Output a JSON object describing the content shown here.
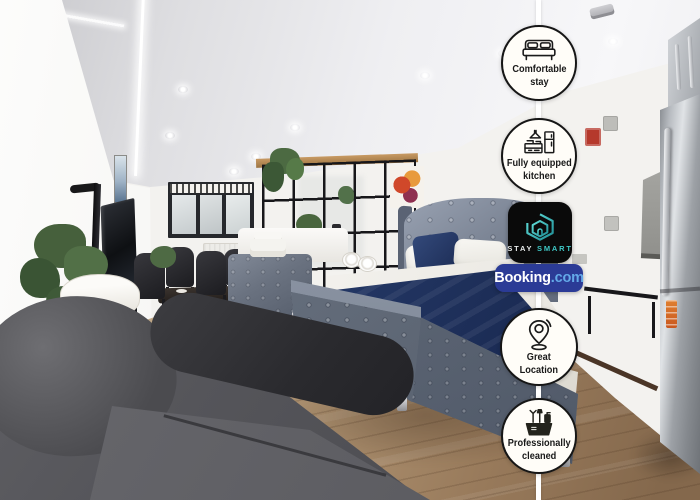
{
  "photo": {
    "alt": "Bright studio apartment: grey velvet beds with navy bedding, grey sofa, dining table with black chairs, black shelving room divider with plants, lamp, TV and stainless steel kitchen"
  },
  "overlay": {
    "connector_color": "#ffffff",
    "badges": [
      {
        "id": "comfortable-stay",
        "icon": "bed-icon",
        "lines": [
          "Comfortable",
          "stay"
        ]
      },
      {
        "id": "fully-equipped-kitchen",
        "icon": "kitchen-icon",
        "lines": [
          "Fully equipped",
          "kitchen"
        ]
      },
      {
        "id": "great-location",
        "icon": "location-pin-icon",
        "lines": [
          "Great",
          "Location"
        ]
      },
      {
        "id": "professionally-cleaned",
        "icon": "cleaning-basket-icon",
        "lines": [
          "Professionally",
          "cleaned"
        ]
      }
    ],
    "staysmart": {
      "line1": "STAY",
      "line2": "SMART",
      "bg": "#0a0a0a",
      "accent": "#3fc8c6",
      "text_color": "#e9ecec"
    },
    "booking": {
      "brand": "Booking",
      "suffix": ".com",
      "bg": "#2b3b96",
      "brand_color": "#ffffff",
      "suffix_color": "#63a9e8"
    }
  }
}
